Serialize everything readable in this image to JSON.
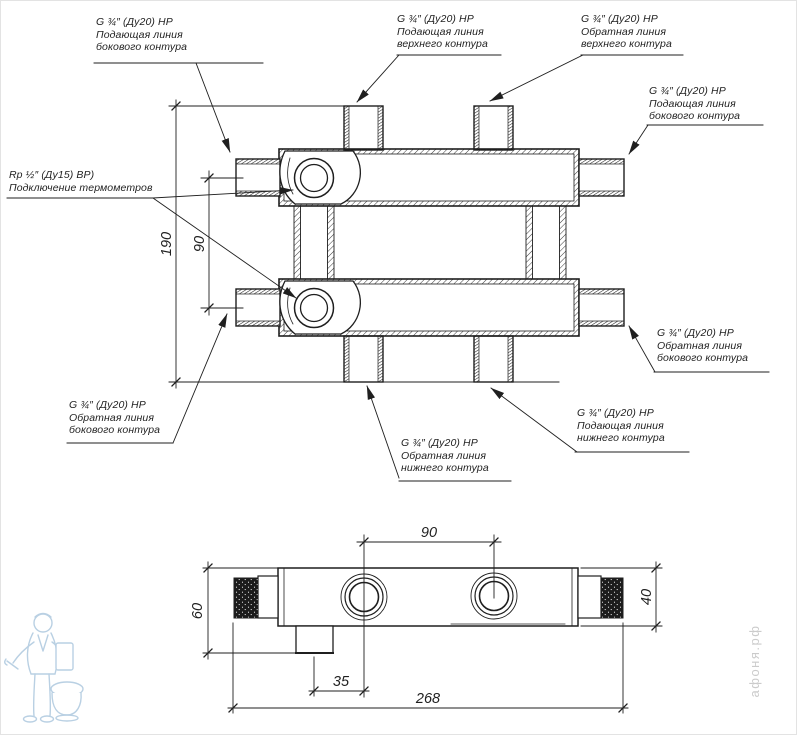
{
  "ports": {
    "top_left": {
      "spec": "G ¾″ (Ду20) НР",
      "line2": "Подающая линия",
      "line3": "бокового контура"
    },
    "top_center_left": {
      "spec": "G ¾″ (Ду20) НР",
      "line2": "Подающая линия",
      "line3": "верхнего контура"
    },
    "top_center_right": {
      "spec": "G ¾″ (Ду20) НР",
      "line2": "Обратная линия",
      "line3": "верхнего контура"
    },
    "right_upper": {
      "spec": "G ¾″ (Ду20) НР",
      "line2": "Подающая линия",
      "line3": "бокового контура"
    },
    "thermometer": {
      "spec": "Rp ½″ (Ду15) ВР)",
      "line2": "Подключение термометров"
    },
    "bottom_left": {
      "spec": "G ¾″ (Ду20) НР",
      "line2": "Обратная линия",
      "line3": "бокового контура"
    },
    "bottom_center_left": {
      "spec": "G ¾″ (Ду20) НР",
      "line2": "Обратная линия",
      "line3": "нижнего контура"
    },
    "bottom_center_right": {
      "spec": "G ¾″ (Ду20) НР",
      "line2": "Подающая линия",
      "line3": "нижнего контура"
    },
    "right_lower": {
      "spec": "G ¾″ (Ду20) НР",
      "line2": "Обратная линия",
      "line3": "бокового контура"
    }
  },
  "dimensions": {
    "overall_height": "190",
    "side_port_spacing": "90",
    "top_port_spacing": "90",
    "tube_offset": "35",
    "overall_length": "268",
    "left_height": "60",
    "body_height": "40"
  },
  "watermark": {
    "site": "афоня.рф"
  },
  "colors": {
    "line": "#1f1f1f",
    "watermark_text": "#cbcbcb",
    "mascot": "#b9d0e3"
  }
}
